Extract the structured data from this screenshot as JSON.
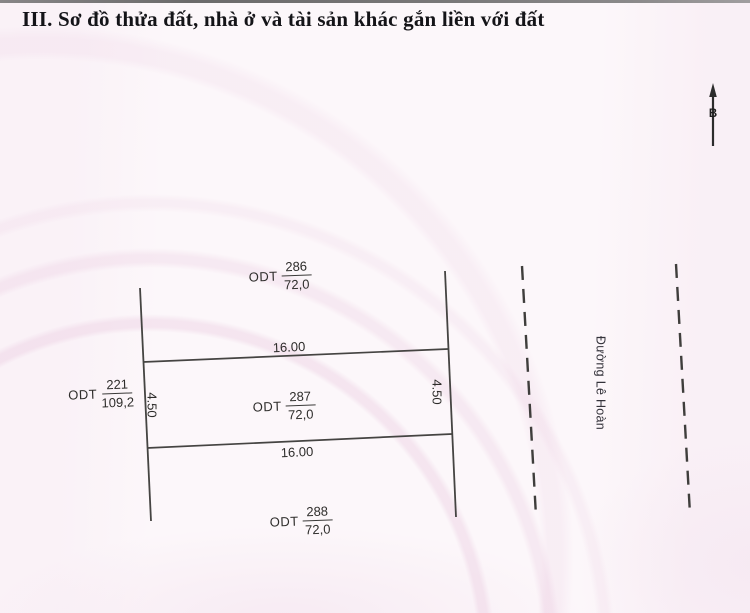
{
  "page": {
    "title": "III. Sơ đồ thửa đất, nhà ở và tài sản khác gắn liền với đất"
  },
  "compass": {
    "north_label": "B"
  },
  "street": {
    "name": "Đường Lê Hoàn"
  },
  "parcels": {
    "p286": {
      "land_use": "ODT",
      "number": "286",
      "area": "72,0"
    },
    "p287": {
      "land_use": "ODT",
      "number": "287",
      "area": "72,0"
    },
    "p288": {
      "land_use": "ODT",
      "number": "288",
      "area": "72,0"
    },
    "p221": {
      "land_use": "ODT",
      "number": "221",
      "area": "109,2"
    }
  },
  "dimensions": {
    "top_width": "16.00",
    "bottom_width": "16.00",
    "left_depth": "4.50",
    "right_depth": "4.50"
  },
  "colors": {
    "line": "#454442",
    "dashed_line": "#3f3e3c",
    "text": "#2e2d2b",
    "background": "#fcf7fa"
  }
}
